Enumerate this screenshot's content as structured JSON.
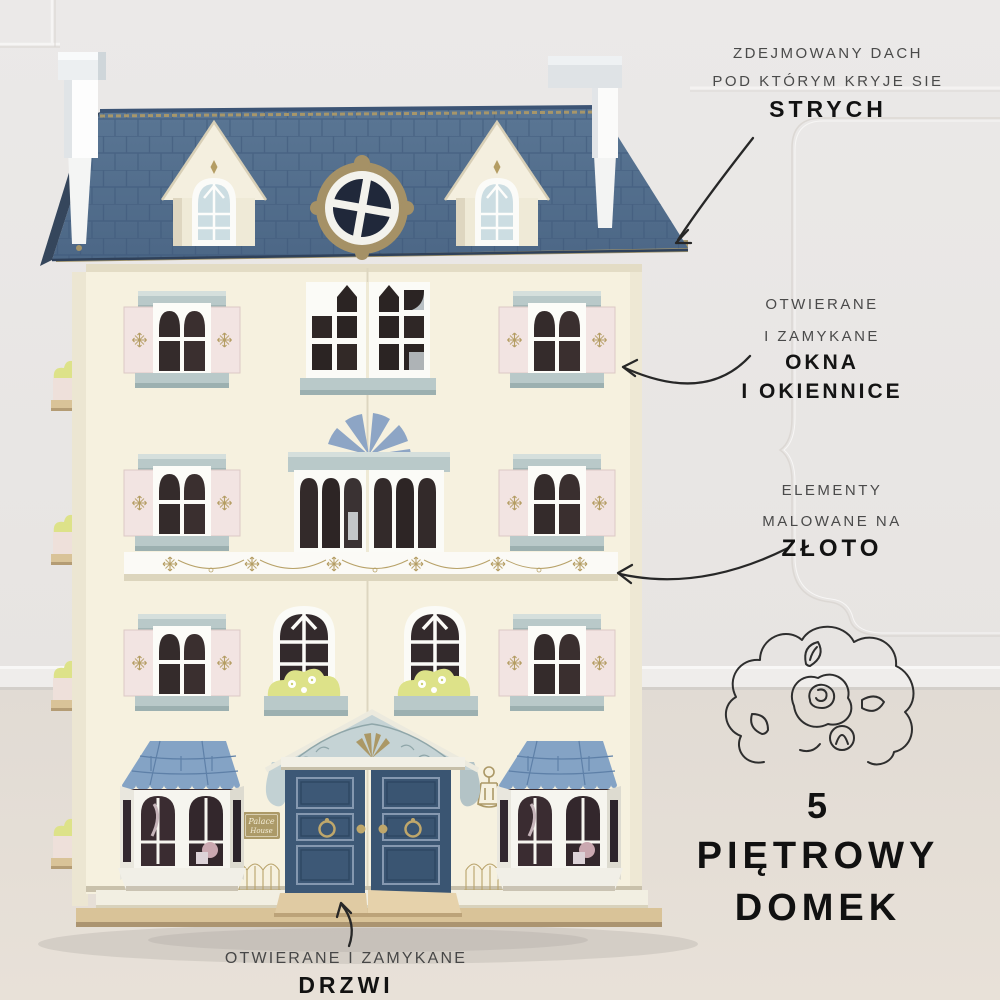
{
  "annotations": {
    "roof": {
      "line1": "ZDEJMOWANY DACH",
      "line2": "POD KTÓRYM KRYJE SIE",
      "emphasis": "STRYCH"
    },
    "windows": {
      "line1": "OTWIERANE",
      "line2": "I ZAMYKANE",
      "emphasis1": "OKNA",
      "emphasis2": "I OKIENNICE"
    },
    "gold": {
      "line1": "ELEMENTY",
      "line2": "MALOWANE NA",
      "emphasis": "ZŁOTO"
    },
    "floors": {
      "count": "5",
      "line1": "PIĘTROWY",
      "line2": "DOMEK"
    },
    "door": {
      "line1": "OTWIERANE I ZAMYKANE",
      "emphasis": "DRZWI"
    }
  },
  "house": {
    "plaque": {
      "line1": "Palace",
      "line2": "House"
    }
  },
  "illustrations": {
    "flower": "flower-bush-line-art",
    "arrows": [
      "arrow-to-roof",
      "arrow-to-windows",
      "arrow-to-gold-frieze",
      "arrow-to-door"
    ]
  },
  "colors": {
    "background_wall": "#e9e7e5",
    "floor": "#e3ddd6",
    "roof_blue": "#53708f",
    "roof_line": "#3e587a",
    "facade_cream": "#f6f1df",
    "shutter_pink": "#f2e4e2",
    "trim_blue_grey": "#b9c9c9",
    "door_navy": "#3d5876",
    "bay_roof_blue": "#84a3c5",
    "gold": "#ab9866",
    "flowerbox_green": "#dde289",
    "wood_base": "#d9c398",
    "text_regular": "#4a4a4a",
    "text_bold": "#141414",
    "arrow_ink": "#272727"
  }
}
